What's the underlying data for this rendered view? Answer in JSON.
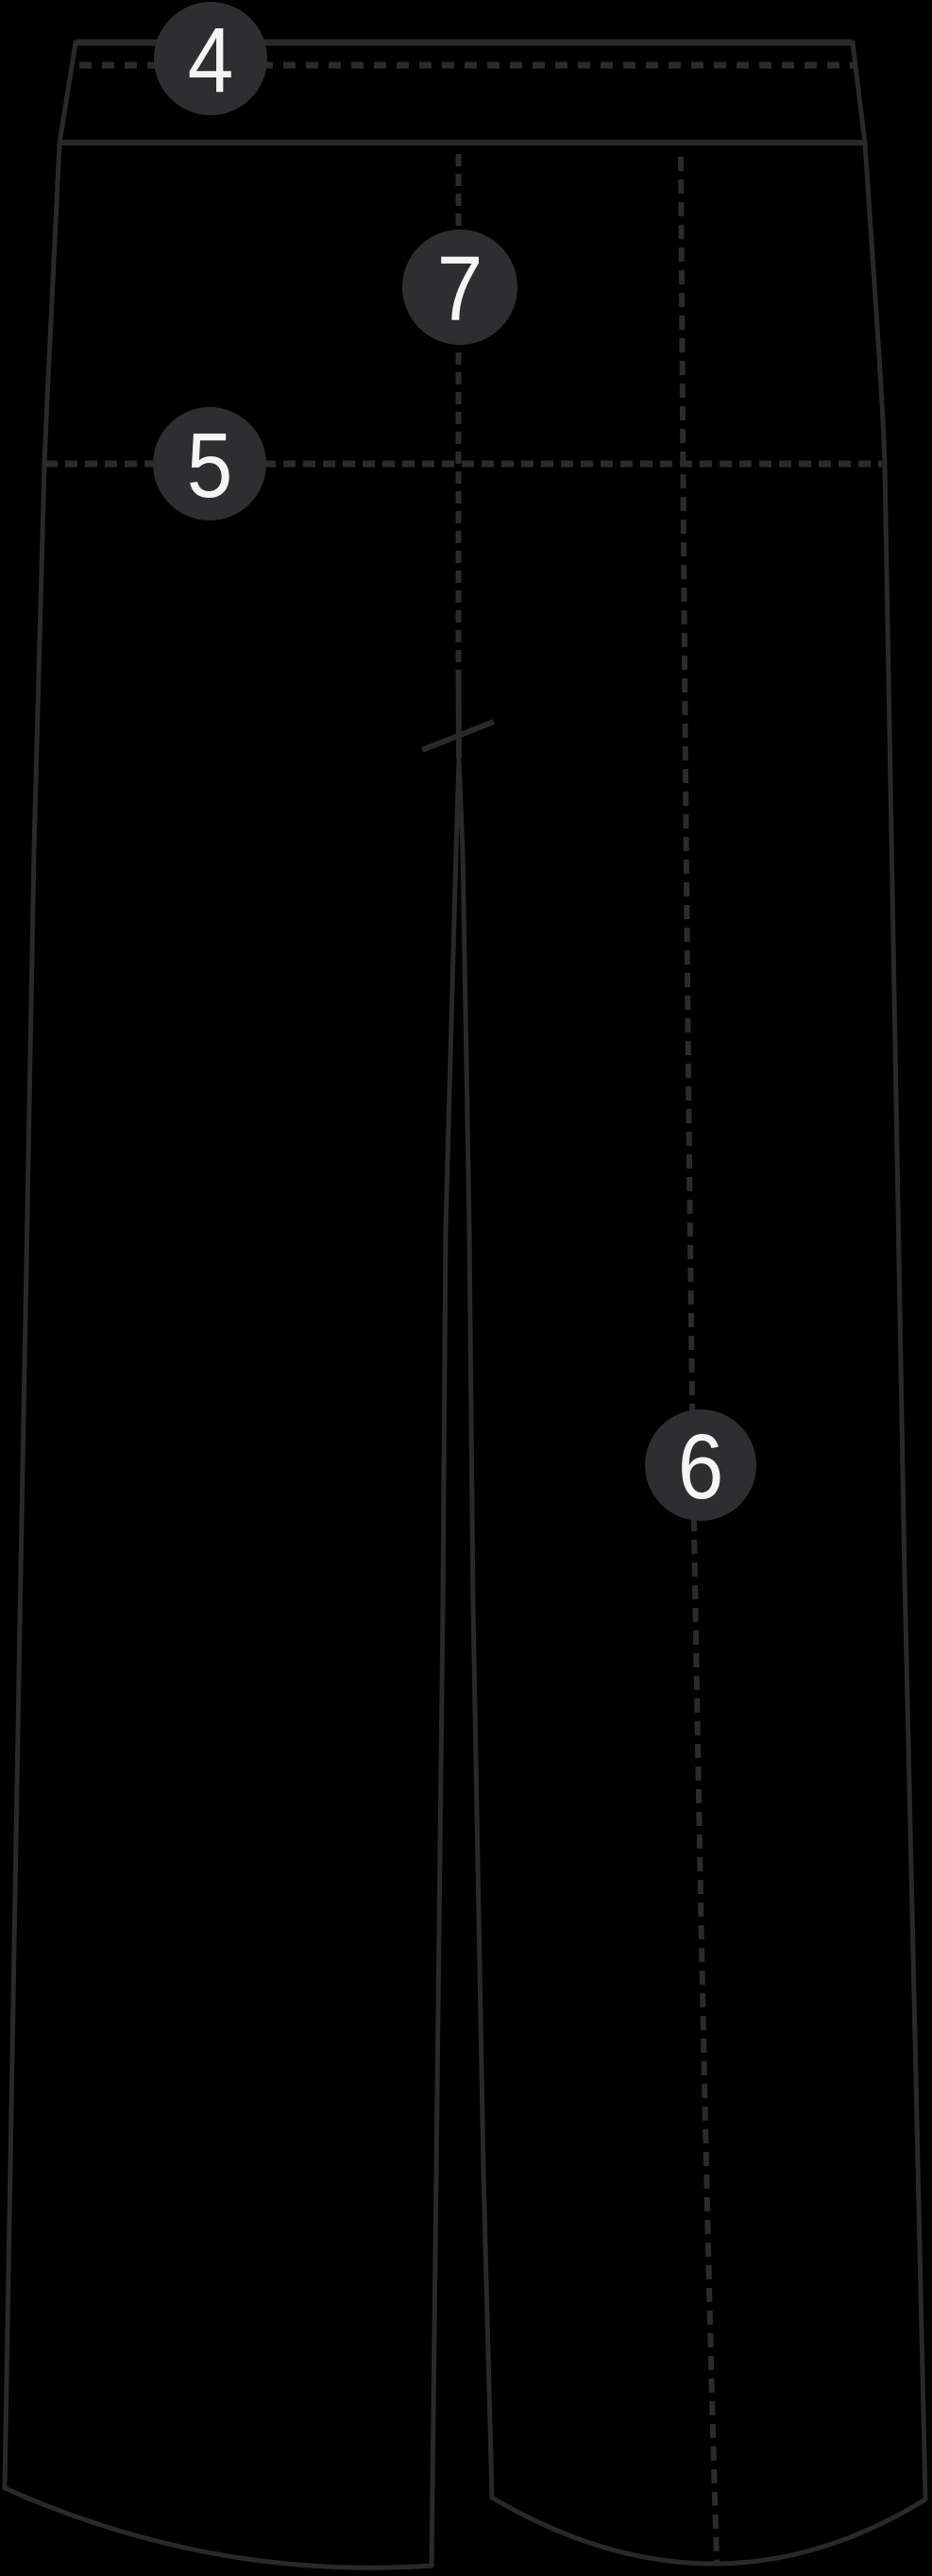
{
  "diagram": {
    "kind": "trousers-front-view-measurement-diagram",
    "markers": [
      {
        "label": "4"
      },
      {
        "label": "5"
      },
      {
        "label": "6"
      },
      {
        "label": "7"
      }
    ]
  },
  "colors": {
    "background": "#000000",
    "garment_fill": "#fdfdfd",
    "outline": "#29292b",
    "dash_line": "#2b2b2d",
    "badge_fill": "#2e2e30",
    "badge_text": "#f4f4f4"
  }
}
